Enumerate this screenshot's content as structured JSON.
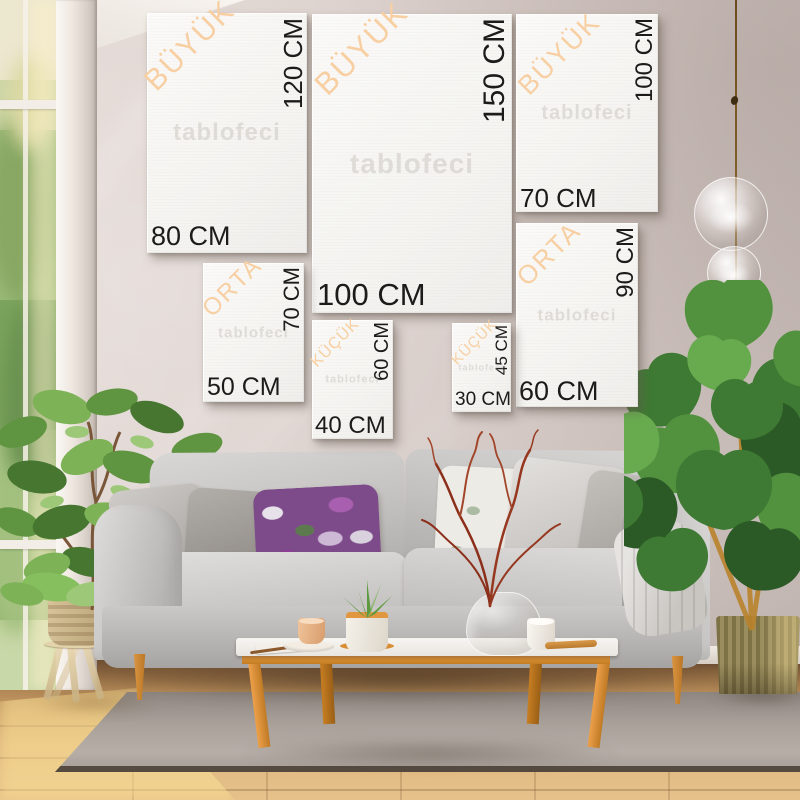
{
  "watermark": "tablofeci",
  "size_guide": {
    "unit": "CM",
    "frames": [
      {
        "category": "BÜYÜK",
        "height_label": "120 CM",
        "width_label": "80 CM"
      },
      {
        "category": "BÜYÜK",
        "height_label": "150 CM",
        "width_label": "100 CM"
      },
      {
        "category": "BÜYÜK",
        "height_label": "100 CM",
        "width_label": "70 CM"
      },
      {
        "category": "ORTA",
        "height_label": "70 CM",
        "width_label": "50 CM"
      },
      {
        "category": "ORTA",
        "height_label": "90 CM",
        "width_label": "60 CM"
      },
      {
        "category": "KÜÇÜK",
        "height_label": "60 CM",
        "width_label": "40 CM"
      },
      {
        "category": "KÜÇÜK",
        "height_label": "45 CM",
        "width_label": "30 CM"
      }
    ]
  },
  "colors": {
    "category_text": "#f7cfa2",
    "dimension_text": "#1c1b19",
    "canvas": "#f7f6f3",
    "wall": "#d5c9c5",
    "wood_accent": "#dd923c",
    "sofa": "#c6c4c2"
  }
}
